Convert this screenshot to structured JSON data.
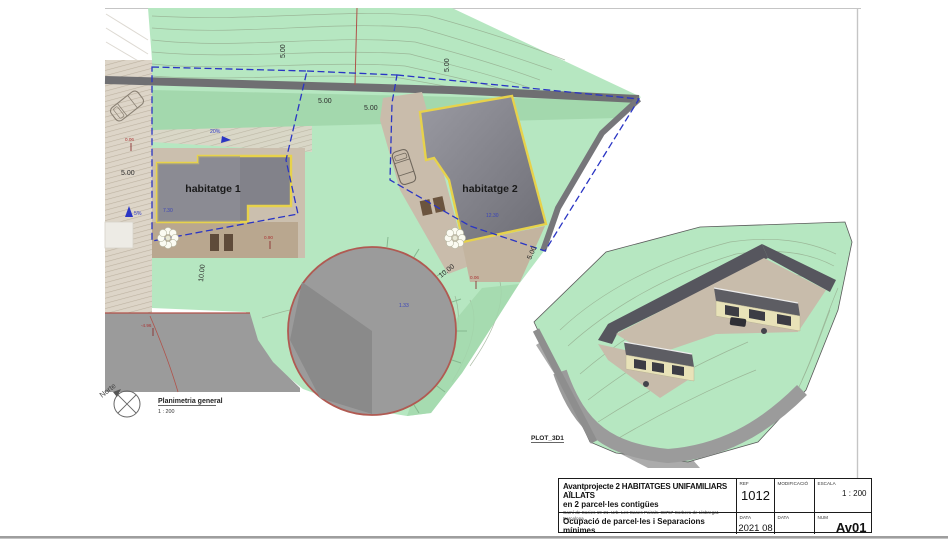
{
  "plan": {
    "view_title": "Planimetria general",
    "view_scale": "1 : 200",
    "north_label": "Norte",
    "building1": "habitatge 1",
    "building2": "habitatge 2",
    "dims": {
      "five": "5.00",
      "ten": "10.00",
      "d730": "7.30",
      "d1230": "12.30",
      "d133": "1.33",
      "d090": "0.90",
      "d006": "0.06",
      "neg496": "-4.96",
      "slope20": "20%",
      "slope5": "5%"
    }
  },
  "view3d": {
    "label": "PLOT_3D1"
  },
  "titleblock": {
    "project_line1": "Avantprojecte  2 HABITATGES UNIFAMILIARS AÏLLATS",
    "project_line2": "en 2 parcel·les contigües",
    "address": "Camí de Socies 19-21. Urb. Les Cases Pairals. 08757 Corbera de Llobregat. Barcelona",
    "sheet_title": "Ocupació de parcel·les i Separacions mínimes",
    "ref": {
      "label": "REF",
      "value": "1012"
    },
    "modificacio": {
      "label": "MODIFICACIÓ",
      "value": ""
    },
    "escala": {
      "label": "ESCALA",
      "value": "1 : 200"
    },
    "data1": {
      "label": "DATA",
      "value": "2021 08"
    },
    "data2": {
      "label": "DATA",
      "value": ""
    },
    "num": {
      "label": "NUM",
      "value": "Av01"
    }
  },
  "colors": {
    "terrain_green": "#b6e7c1",
    "terrain_green_dark": "#a3d8ad",
    "paving_tan": "#cbbfae",
    "terrace_tan": "#b9a78f",
    "building_gray": "#82828a",
    "building_outline_yellow": "#e7d24b",
    "parcel_blue": "#2a35c4",
    "road_gray": "#9b9b9b",
    "wall_gray": "#6f6f72",
    "red_line": "#b0524a"
  }
}
